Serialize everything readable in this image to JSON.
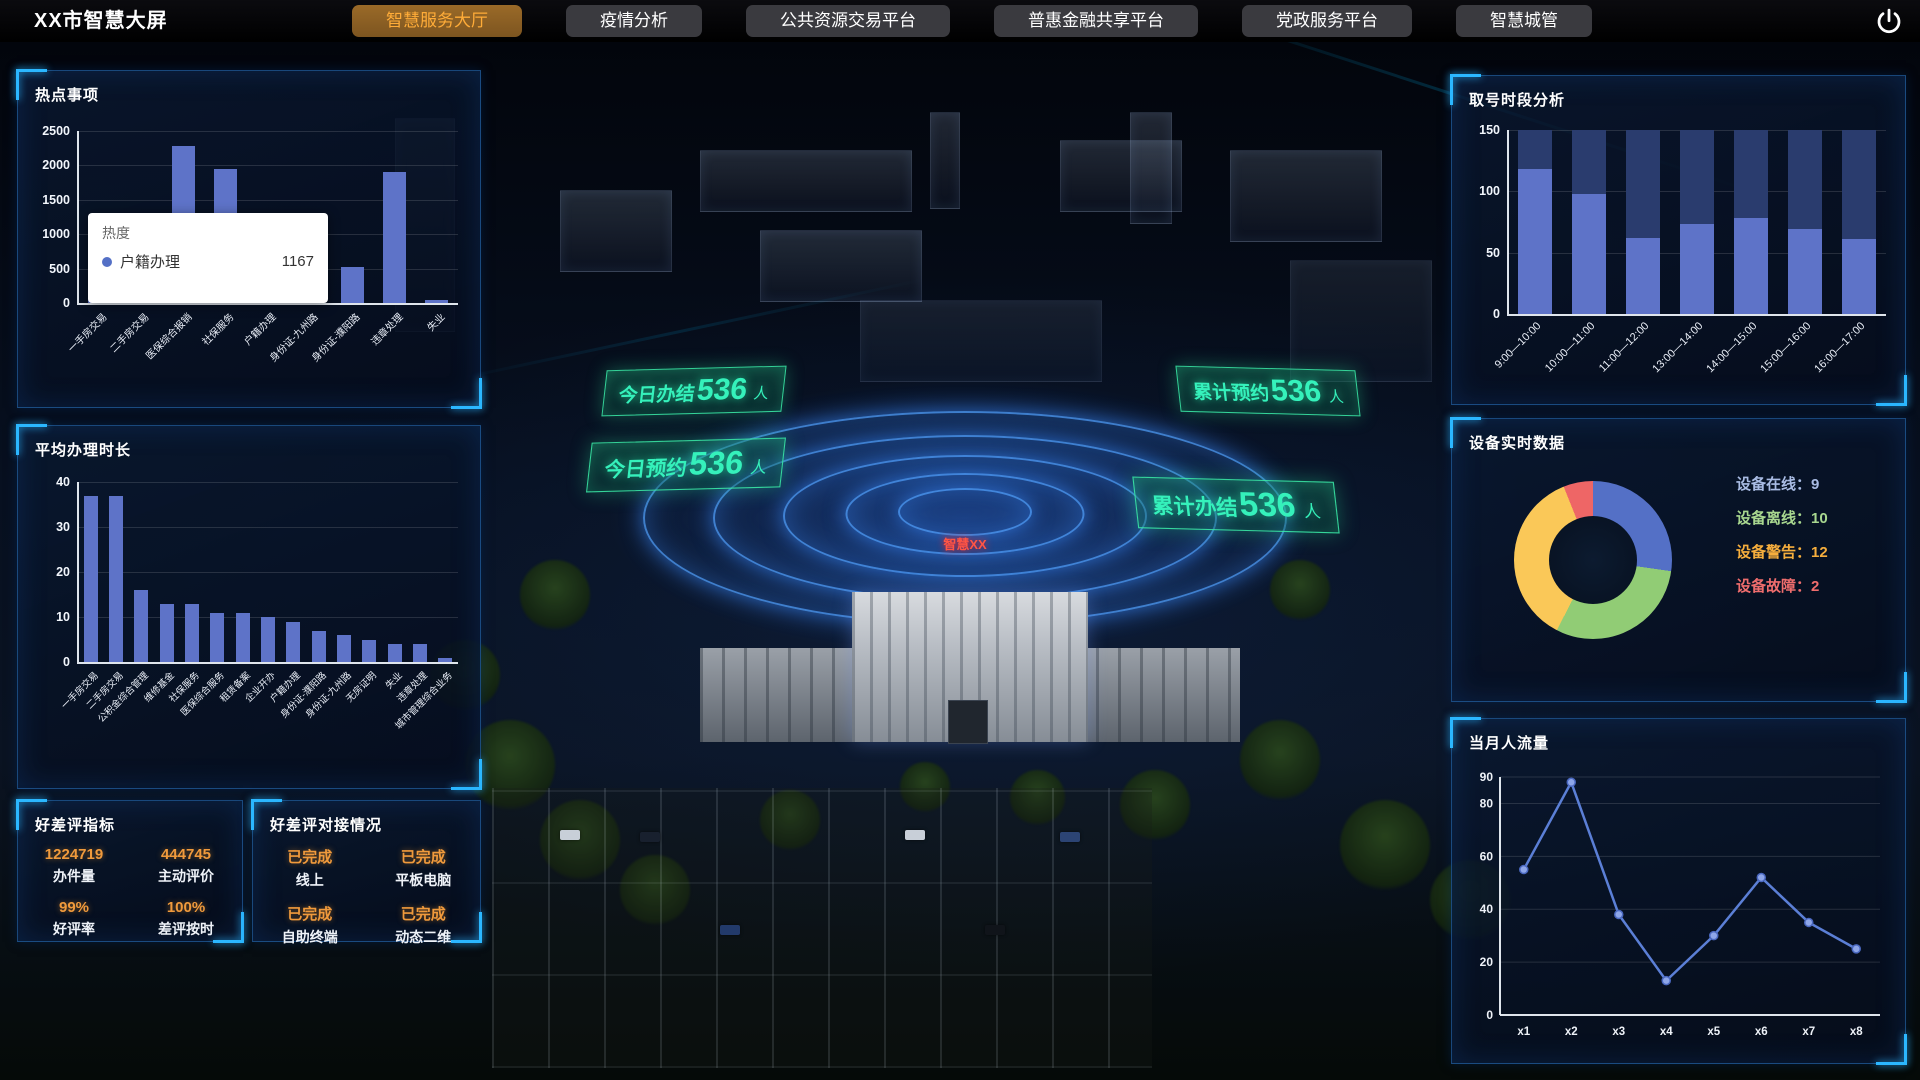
{
  "nav": {
    "title": "XX市智慧大屏",
    "tabs": [
      {
        "label": "智慧服务大厅",
        "active": true
      },
      {
        "label": "疫情分析",
        "active": false
      },
      {
        "label": "公共资源交易平台",
        "active": false
      },
      {
        "label": "普惠金融共享平台",
        "active": false
      },
      {
        "label": "党政服务平台",
        "active": false
      },
      {
        "label": "智慧城管",
        "active": false
      }
    ],
    "power_icon": "power-icon",
    "colors": {
      "active_bg": "#8a5f22",
      "active_text": "#ffac38",
      "tab_bg": "#3a3a3f",
      "tab_text": "#ffffff"
    }
  },
  "left": {
    "hot_items": {
      "title": "热点事项",
      "chart_data": {
        "type": "bar",
        "categories": [
          "一手房交易",
          "二手房交易",
          "医保综合报销",
          "社保服务",
          "户籍办理",
          "身份证-九州路",
          "身份证-濮阳路",
          "违章处理",
          "失业"
        ],
        "values": [
          1270,
          1210,
          2280,
          1950,
          1167,
          820,
          530,
          1900,
          50
        ],
        "title": "热点事项",
        "xlabel": "",
        "ylabel": "",
        "ylim": [
          0,
          2500
        ],
        "yticks": [
          0,
          500,
          1000,
          1500,
          2000,
          2500
        ],
        "bar_color": "#5e73c8",
        "bar_frac": 0.55,
        "label_size": 10,
        "grid": true
      },
      "tooltip": {
        "title": "热度",
        "series": "户籍办理",
        "value": "1167",
        "dot_color": "#5470c6"
      }
    },
    "avg_time": {
      "title": "平均办理时长",
      "chart_data": {
        "type": "bar",
        "categories": [
          "一手房交易",
          "二手房交易",
          "公积金综合管理",
          "维修基金",
          "社保服务",
          "医保综合服务",
          "租赁备案",
          "企业开办",
          "户籍办理",
          "身份证-濮阳路",
          "身份证-九州路",
          "无房证明",
          "失业",
          "违章处理",
          "城市管理综合业务"
        ],
        "values": [
          37,
          37,
          16,
          13,
          13,
          11,
          11,
          10,
          9,
          7,
          6,
          5,
          4,
          4,
          1
        ],
        "title": "平均办理时长",
        "xlabel": "",
        "ylabel": "",
        "ylim": [
          0,
          40
        ],
        "yticks": [
          0,
          10,
          20,
          30,
          40
        ],
        "bar_color": "#5e73c8",
        "bar_frac": 0.55,
        "label_size": 9.5,
        "grid": true
      }
    },
    "rating_metrics": {
      "title": "好差评指标",
      "stats": [
        {
          "value": "1224719",
          "label": "办件量"
        },
        {
          "value": "444745",
          "label": "主动评价"
        },
        {
          "value": "99%",
          "label": "好评率"
        },
        {
          "value": "100%",
          "label": "差评按时"
        }
      ]
    },
    "rating_integration": {
      "title": "好差评对接情况",
      "stats": [
        {
          "value": "已完成",
          "label": "线上"
        },
        {
          "value": "已完成",
          "label": "平板电脑"
        },
        {
          "value": "已完成",
          "label": "自助终端"
        },
        {
          "value": "已完成",
          "label": "动态二维"
        }
      ]
    }
  },
  "right": {
    "queue_analysis": {
      "title": "取号时段分析",
      "chart_data": {
        "type": "bar",
        "categories": [
          "9:00—10:00",
          "10:00—11:00",
          "11:00—12:00",
          "13:00—14:00",
          "14:00—15:00",
          "15:00—16:00",
          "16:00—17:00"
        ],
        "values": [
          118,
          98,
          62,
          73,
          78,
          69,
          61
        ],
        "title": "取号时段分析",
        "xlabel": "",
        "ylabel": "",
        "ylim": [
          0,
          150
        ],
        "yticks": [
          0,
          50,
          100,
          150
        ],
        "bar_color": "#5e73c8",
        "bg_bar_color": "#2a3c6e",
        "bg_bar_value": 150,
        "bar_frac": 0.62,
        "label_size": 11,
        "grid": true
      }
    },
    "device_data": {
      "title": "设备实时数据",
      "chart_data": {
        "type": "pie",
        "series": [
          {
            "name": "设备在线",
            "value": 9,
            "color": "#5470c6",
            "text_color": "#a9bce4"
          },
          {
            "name": "设备离线",
            "value": 10,
            "color": "#91cc75",
            "text_color": "#a8d78f"
          },
          {
            "name": "设备警告",
            "value": 12,
            "color": "#fac858",
            "text_color": "#f6ae3d"
          },
          {
            "name": "设备故障",
            "value": 2,
            "color": "#ee6666",
            "text_color": "#ef6d6d"
          }
        ],
        "title": "设备实时数据",
        "legend_position": "right"
      }
    },
    "monthly_flow": {
      "title": "当月人流量",
      "chart_data": {
        "type": "line",
        "x": [
          "x1",
          "x2",
          "x3",
          "x4",
          "x5",
          "x6",
          "x7",
          "x8"
        ],
        "values": [
          55,
          88,
          38,
          13,
          30,
          52,
          35,
          25
        ],
        "title": "当月人流量",
        "xlabel": "",
        "ylabel": "",
        "ylim": [
          0,
          90
        ],
        "yticks": [
          0,
          20,
          40,
          60,
          80,
          90
        ],
        "line_color": "#5b7fd6",
        "marker_fill": "#8ea6e8",
        "marker_stroke": "#4a68c0",
        "grid": true
      }
    }
  },
  "scene": {
    "overlays": [
      {
        "label": "今日办结",
        "value": "536",
        "unit": "人"
      },
      {
        "label": "今日预约",
        "value": "536",
        "unit": "人"
      },
      {
        "label": "累计预约",
        "value": "536",
        "unit": "人"
      },
      {
        "label": "累计办结",
        "value": "536",
        "unit": "人"
      }
    ],
    "building_sign": "智慧XX",
    "accent_color": "#2ef0b0"
  }
}
